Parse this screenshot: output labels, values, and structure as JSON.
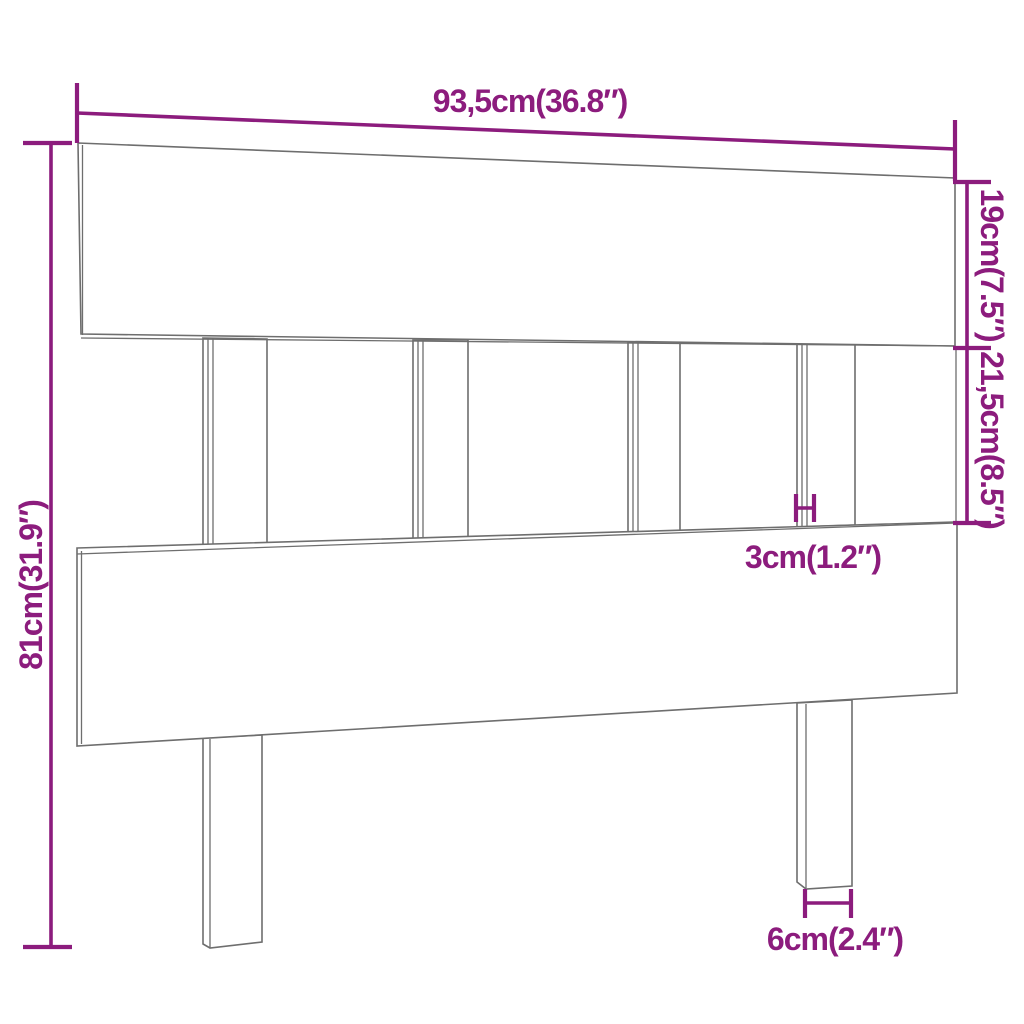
{
  "diagram": {
    "kind": "furniture-dimension-diagram",
    "subject": "bed-headboard",
    "dimensions": {
      "width": {
        "label": "93,5cm(36.8″)"
      },
      "top_board_height": {
        "label": "19cm(7.5″)"
      },
      "middle_section_height": {
        "label": "21,5cm(8.5″)"
      },
      "total_height": {
        "label": "81cm(31.9″)"
      },
      "slat_thickness": {
        "label": "3cm(1.2″)"
      },
      "leg_width": {
        "label": "6cm(2.4″)"
      }
    },
    "colors": {
      "dimension_annotation": "#8C1C7D",
      "product_outline": "#6E6E6E",
      "background": "#FFFFFF"
    }
  }
}
